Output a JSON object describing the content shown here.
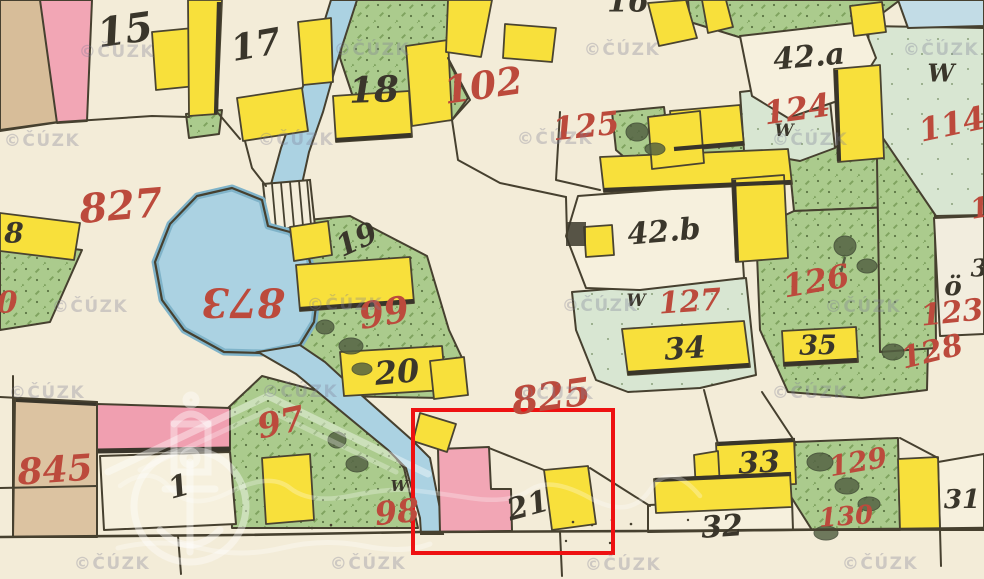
{
  "map": {
    "title": "historical cadastral map sheet",
    "watermark": {
      "text": "©ČÚZK",
      "positions": [
        [
          117,
          52
        ],
        [
          372,
          50
        ],
        [
          622,
          50
        ],
        [
          941,
          50
        ],
        [
          42,
          141
        ],
        [
          296,
          140
        ],
        [
          555,
          139
        ],
        [
          810,
          140
        ],
        [
          90,
          307
        ],
        [
          345,
          305
        ],
        [
          600,
          306
        ],
        [
          863,
          307
        ],
        [
          47,
          393
        ],
        [
          300,
          392
        ],
        [
          556,
          394
        ],
        [
          810,
          393
        ],
        [
          112,
          564
        ],
        [
          368,
          564
        ],
        [
          623,
          565
        ],
        [
          880,
          564
        ]
      ]
    },
    "highlight_box": {
      "x": 411,
      "y": 408,
      "width": 204,
      "height": 147
    },
    "colors": {
      "background": "#f3ecd8",
      "ink": "#46402f",
      "label_red": "#bc4a3c",
      "label_black": "#3a362b",
      "building_yellow": "#f8e03b",
      "building_pink": "#f2a6b5",
      "garden_green": "#abcb8d",
      "meadow_green": "#d8e6d2",
      "water_blue": "#abd2e2",
      "field_tan": "#d7bd99",
      "highlight_red": "#ee1111"
    },
    "labels": {
      "items": [
        {
          "t": "15",
          "x": 125,
          "y": 30,
          "s": 40,
          "r": -8,
          "c": "black"
        },
        {
          "t": "17",
          "x": 256,
          "y": 45,
          "s": 36,
          "r": -10,
          "c": "black"
        },
        {
          "t": "16",
          "x": 628,
          "y": 2,
          "s": 30,
          "r": 0,
          "c": "black"
        },
        {
          "t": "18",
          "x": 374,
          "y": 90,
          "s": 36,
          "r": -2,
          "c": "black"
        },
        {
          "t": "42.a",
          "x": 809,
          "y": 57,
          "s": 30,
          "r": -5,
          "c": "black"
        },
        {
          "t": "W",
          "x": 941,
          "y": 73,
          "s": 24,
          "r": 0,
          "c": "black"
        },
        {
          "t": "42.b",
          "x": 664,
          "y": 232,
          "s": 30,
          "r": -5,
          "c": "black"
        },
        {
          "t": "19",
          "x": 357,
          "y": 240,
          "s": 30,
          "r": -25,
          "c": "black"
        },
        {
          "t": "20",
          "x": 397,
          "y": 372,
          "s": 32,
          "r": -5,
          "c": "black"
        },
        {
          "t": "W",
          "x": 784,
          "y": 131,
          "s": 17,
          "r": 0,
          "c": "black"
        },
        {
          "t": "W",
          "x": 636,
          "y": 301,
          "s": 17,
          "r": 0,
          "c": "black"
        },
        {
          "t": "W",
          "x": 399,
          "y": 486,
          "s": 15,
          "r": 0,
          "c": "black"
        },
        {
          "t": "34",
          "x": 685,
          "y": 349,
          "s": 30,
          "r": -4,
          "c": "black"
        },
        {
          "t": "35",
          "x": 818,
          "y": 346,
          "s": 27,
          "r": 0,
          "c": "black"
        },
        {
          "t": "ö",
          "x": 953,
          "y": 287,
          "s": 26,
          "r": 0,
          "c": "black"
        },
        {
          "t": "8",
          "x": 14,
          "y": 233,
          "s": 28,
          "r": 0,
          "c": "black"
        },
        {
          "t": "1",
          "x": 179,
          "y": 487,
          "s": 30,
          "r": -15,
          "c": "black"
        },
        {
          "t": "21",
          "x": 528,
          "y": 506,
          "s": 30,
          "r": -15,
          "c": "black"
        },
        {
          "t": "32",
          "x": 722,
          "y": 527,
          "s": 30,
          "r": -4,
          "c": "black"
        },
        {
          "t": "33",
          "x": 759,
          "y": 463,
          "s": 30,
          "r": -3,
          "c": "black"
        },
        {
          "t": "31",
          "x": 962,
          "y": 500,
          "s": 26,
          "r": 0,
          "c": "black"
        },
        {
          "t": "3",
          "x": 979,
          "y": 268,
          "s": 24,
          "r": 0,
          "c": "black"
        },
        {
          "t": "827",
          "x": 121,
          "y": 206,
          "s": 40,
          "r": -5,
          "c": "red"
        },
        {
          "t": "873",
          "x": 243,
          "y": 302,
          "s": 40,
          "r": 180,
          "c": "red"
        },
        {
          "t": "102",
          "x": 483,
          "y": 85,
          "s": 38,
          "r": -8,
          "c": "red"
        },
        {
          "t": "125",
          "x": 586,
          "y": 126,
          "s": 32,
          "r": -6,
          "c": "red"
        },
        {
          "t": "124",
          "x": 797,
          "y": 109,
          "s": 32,
          "r": -8,
          "c": "red"
        },
        {
          "t": "114",
          "x": 952,
          "y": 124,
          "s": 32,
          "r": -12,
          "c": "red"
        },
        {
          "t": "99",
          "x": 384,
          "y": 313,
          "s": 36,
          "r": -10,
          "c": "red"
        },
        {
          "t": "825",
          "x": 551,
          "y": 396,
          "s": 38,
          "r": -8,
          "c": "red"
        },
        {
          "t": "97",
          "x": 281,
          "y": 423,
          "s": 34,
          "r": -12,
          "c": "red"
        },
        {
          "t": "98",
          "x": 397,
          "y": 512,
          "s": 32,
          "r": -6,
          "c": "red"
        },
        {
          "t": "845",
          "x": 55,
          "y": 470,
          "s": 36,
          "r": -4,
          "c": "red"
        },
        {
          "t": "126",
          "x": 816,
          "y": 281,
          "s": 32,
          "r": -10,
          "c": "red"
        },
        {
          "t": "127",
          "x": 690,
          "y": 302,
          "s": 30,
          "r": -4,
          "c": "red"
        },
        {
          "t": "123",
          "x": 952,
          "y": 313,
          "s": 30,
          "r": -6,
          "c": "red"
        },
        {
          "t": "128",
          "x": 932,
          "y": 352,
          "s": 30,
          "r": -14,
          "c": "red"
        },
        {
          "t": "129",
          "x": 858,
          "y": 462,
          "s": 28,
          "r": -10,
          "c": "red"
        },
        {
          "t": "130",
          "x": 846,
          "y": 517,
          "s": 26,
          "r": -4,
          "c": "red"
        },
        {
          "t": "0",
          "x": 7,
          "y": 303,
          "s": 30,
          "r": 0,
          "c": "red"
        },
        {
          "t": "1",
          "x": 980,
          "y": 208,
          "s": 28,
          "r": -10,
          "c": "red"
        }
      ]
    }
  }
}
